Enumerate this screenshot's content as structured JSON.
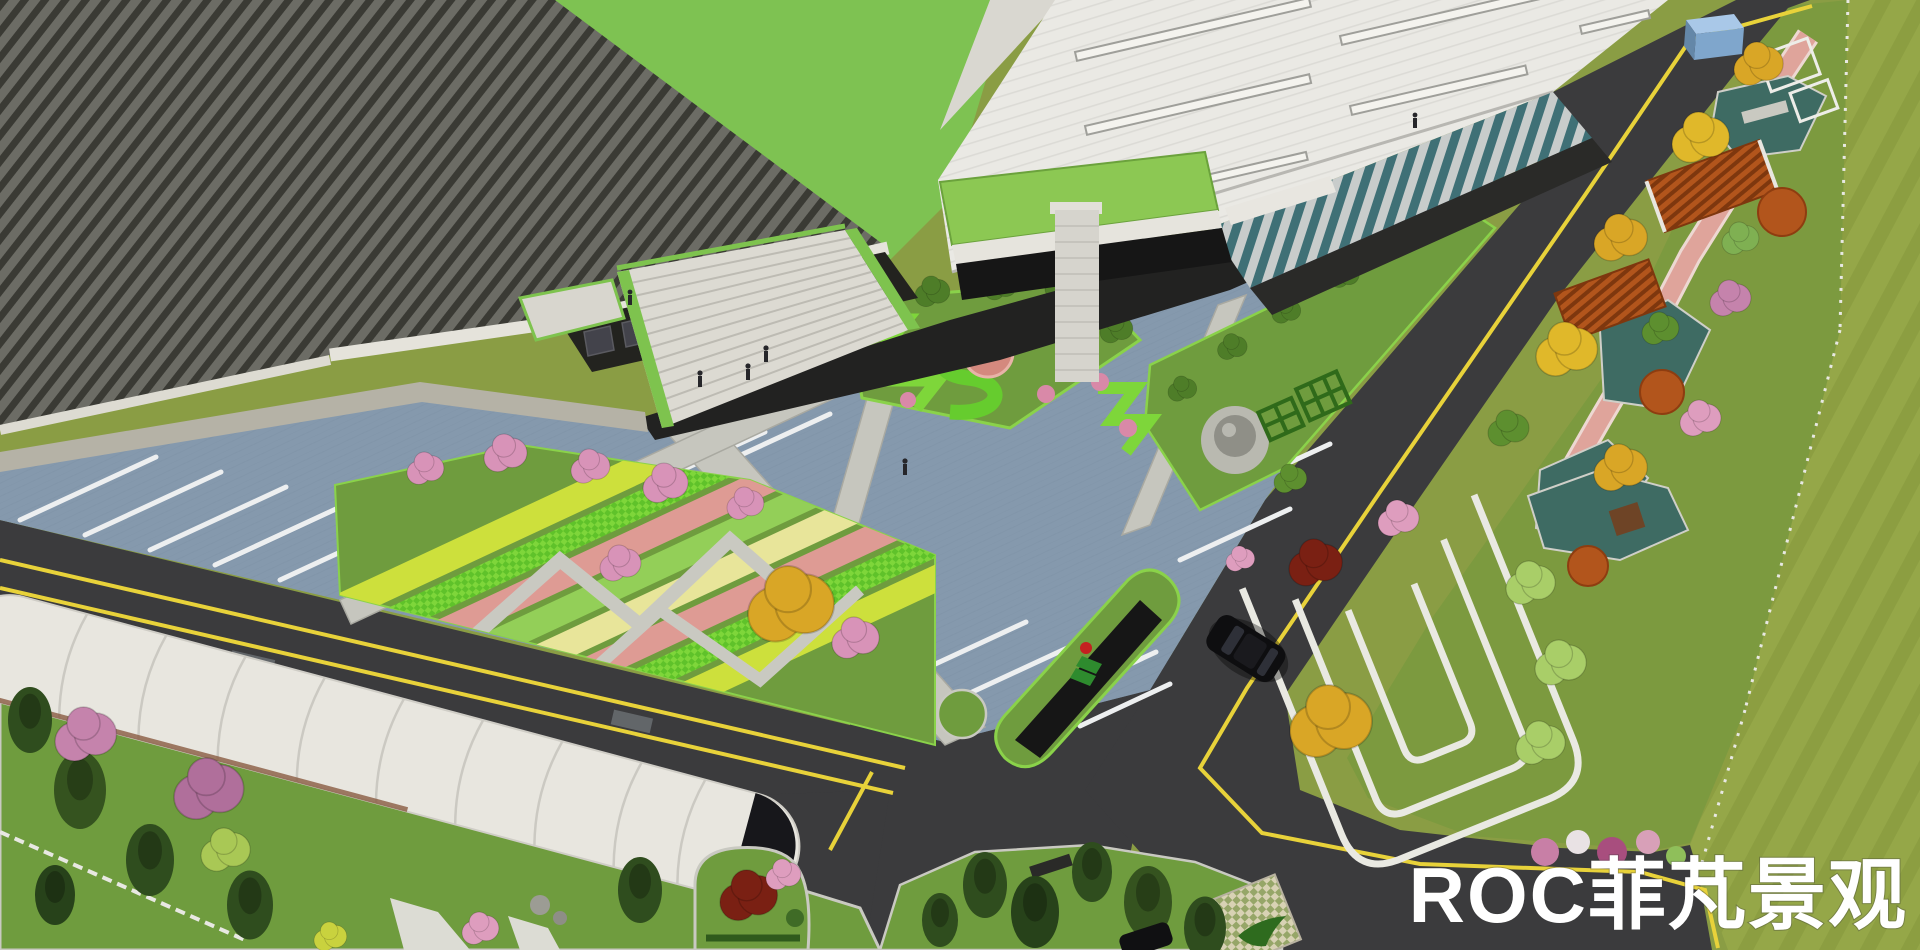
{
  "watermark": {
    "text": "ROC菲芃景观",
    "color": "#ffffff"
  },
  "palette": {
    "asphalt": "#3B3B3D",
    "lane_line": "#E8D23A",
    "parking_paving": "#8599AD",
    "stall_stripe": "#EDEFF0",
    "lawn_olive": "#8A9D44",
    "lawn_green": "#6F9C3E",
    "grounds_green": "#7C9A3F",
    "hedge_bright": "#7ED63A",
    "pink_paving": "#DFA49B",
    "pond_teal": "#3E6B63",
    "warehouse_roof": "#E9E8E3",
    "dark_roof_light": "#6C6C65",
    "dark_roof_dark": "#3A3A34",
    "green_roof": "#8CC853",
    "pergola_wood": "#B2551C",
    "membrane_white": "#E8E6DF",
    "stair_green_trim": "#7EC34E"
  }
}
